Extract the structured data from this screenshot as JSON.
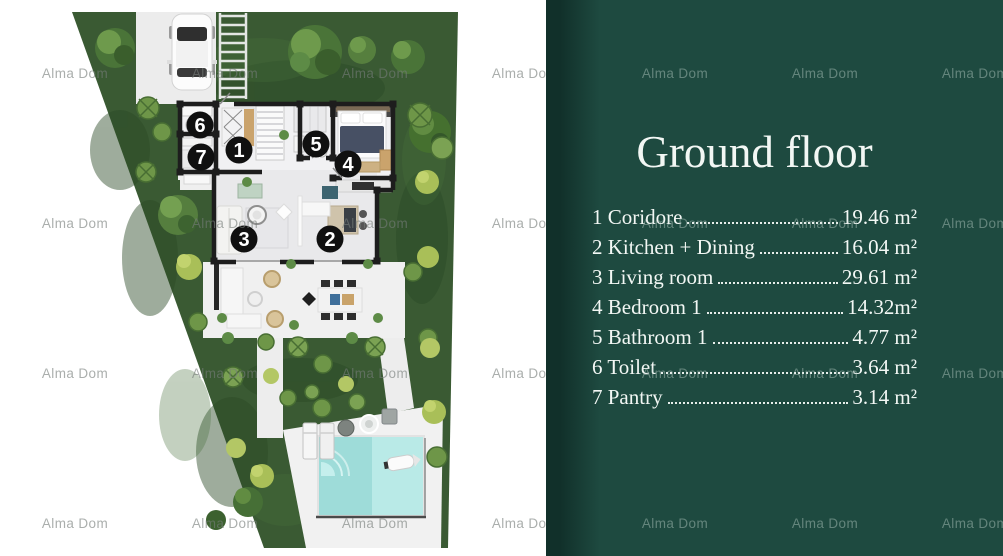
{
  "title": "Ground floor",
  "watermark": "Alma Dom",
  "legend": {
    "rooms": [
      {
        "num": "1",
        "name": "Coridore",
        "area": "19.46 m²"
      },
      {
        "num": "2",
        "name": "Kitchen + Dining",
        "area": "16.04 m²"
      },
      {
        "num": "3",
        "name": "Living room",
        "area": "29.61 m²"
      },
      {
        "num": "4",
        "name": "Bedroom 1",
        "area": "14.32m²"
      },
      {
        "num": "5",
        "name": "Bathroom 1",
        "area": "4.77 m²"
      },
      {
        "num": "6",
        "name": "Toilet",
        "area": "3.64 m²"
      },
      {
        "num": "7",
        "name": "Pantry",
        "area": "3.14 m²"
      }
    ]
  },
  "floorplan": {
    "room_markers": [
      {
        "num": "1",
        "x": 239,
        "y": 150
      },
      {
        "num": "2",
        "x": 330,
        "y": 239
      },
      {
        "num": "3",
        "x": 244,
        "y": 239
      },
      {
        "num": "4",
        "x": 348,
        "y": 164
      },
      {
        "num": "5",
        "x": 316,
        "y": 144
      },
      {
        "num": "6",
        "x": 200,
        "y": 125
      },
      {
        "num": "7",
        "x": 201,
        "y": 157
      }
    ]
  },
  "colors": {
    "panel-bg": "#1e4a40",
    "panel-strip": "#11302a",
    "panel-text": "#f2f7f4",
    "grass": "#3a5a33",
    "pool-water": "#9edcd9",
    "wall": "#1d1d1d",
    "marker-bg": "#101010"
  }
}
